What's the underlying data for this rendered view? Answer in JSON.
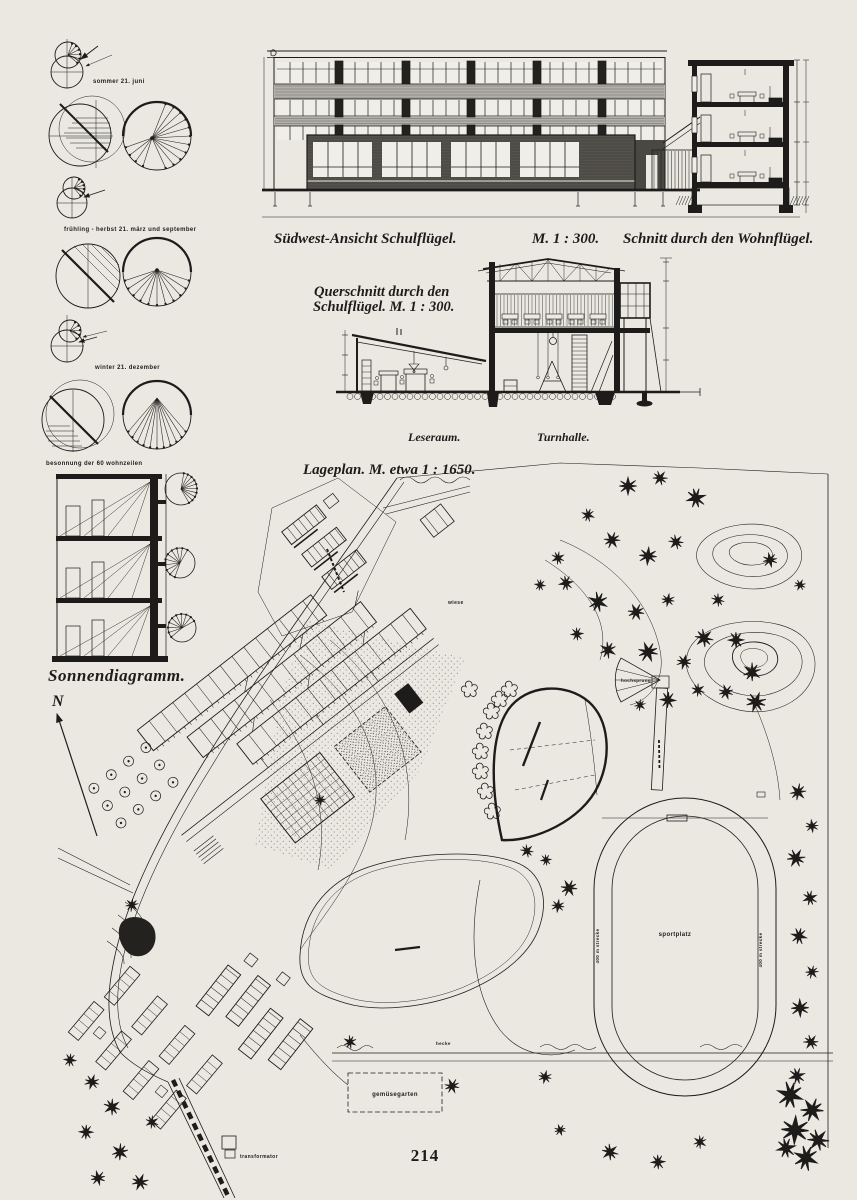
{
  "page": {
    "number": "214",
    "background": "#ebe8e2",
    "ink": "#1d1c1a"
  },
  "sun_diagrams": {
    "title": "Sonnendiagramm.",
    "north_label": "N",
    "summer_label": "sommer 21. juni",
    "spring_label": "frühling - herbst  21. märz und september",
    "winter_label": "winter 21. dezember",
    "besonnung_label": "besonnung der 60 wohnzeilen"
  },
  "elevation": {
    "caption": "Südwest-Ansicht Schulflügel.",
    "scale_label": "M. 1 : 300.",
    "section_caption": "Schnitt durch den Wohnflügel."
  },
  "cross_section": {
    "caption_line1": "Querschnitt durch den",
    "caption_line2": "Schulflügel.  M. 1 : 300.",
    "room_left_label": "Leseraum.",
    "room_right_label": "Turnhalle."
  },
  "site_plan": {
    "caption": "Lageplan.  M. etwa 1 : 1650.",
    "sportplatz_label": "sportplatz",
    "track_label_left": "400 m strecke",
    "track_label_right": "400 m strecke",
    "hochsprung_label": "hochsprung",
    "wiese_label": "wiese",
    "hecke_label": "hecke",
    "gemuesegarten_label": "gemüsegarten",
    "transformator_label": "transformator"
  }
}
